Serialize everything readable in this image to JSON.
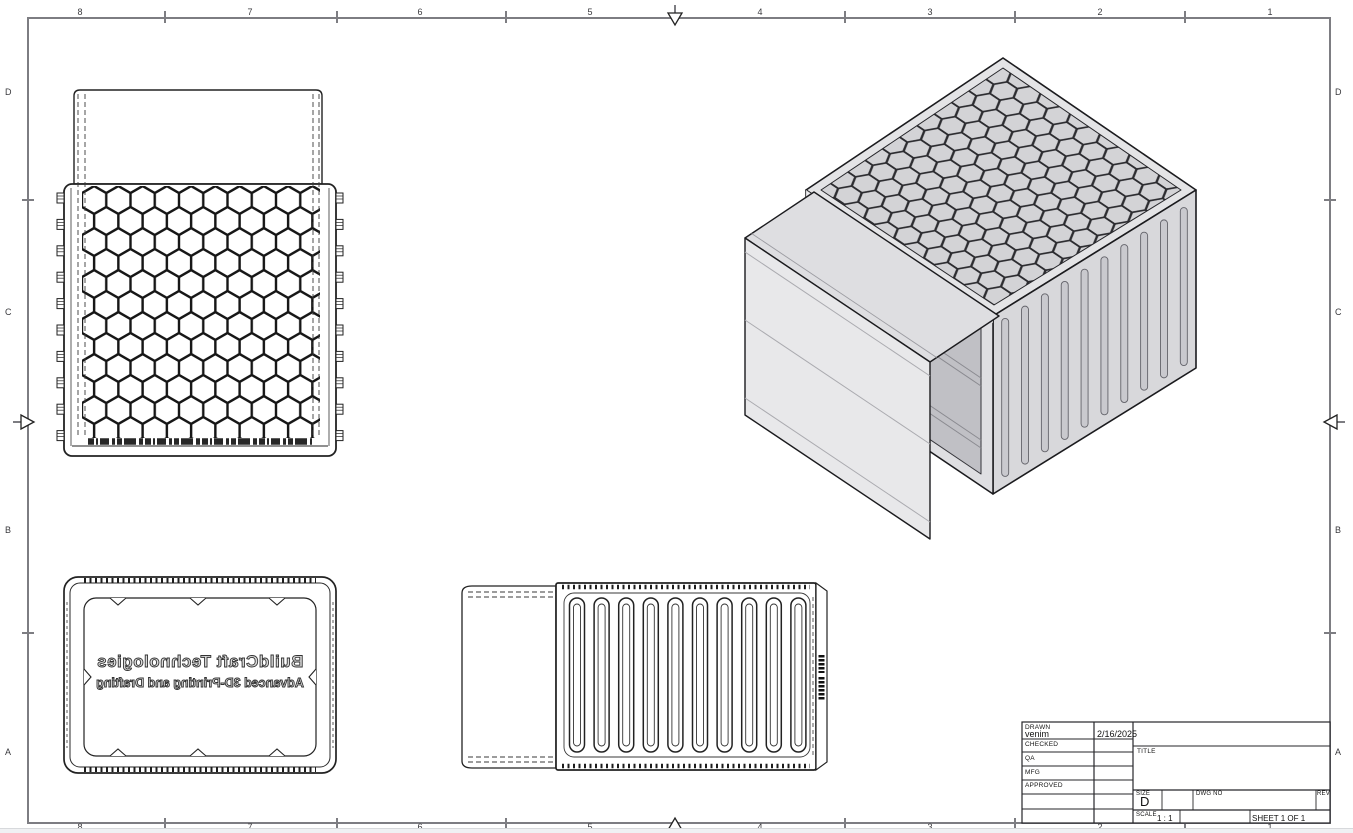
{
  "sheet": {
    "zones_top": [
      "8",
      "7",
      "6",
      "5",
      "4",
      "3",
      "2",
      "1"
    ],
    "zones_bottom": [
      "8",
      "7",
      "6",
      "5",
      "4",
      "3",
      "2",
      "1"
    ],
    "zones_left": [
      "D",
      "C",
      "B",
      "A"
    ],
    "zones_right": [
      "D",
      "C",
      "B",
      "A"
    ]
  },
  "title_block": {
    "drawn_label": "DRAWN",
    "drawn_by": "venim",
    "drawn_date": "2/16/2025",
    "checked_label": "CHECKED",
    "qa_label": "QA",
    "mfg_label": "MFG",
    "approved_label": "APPROVED",
    "title_label": "TITLE",
    "size_label": "SIZE",
    "size_value": "D",
    "dwg_no_label": "DWG NO",
    "rev_label": "REV",
    "scale_label": "SCALE",
    "scale_value": "1 : 1",
    "sheet_value": "SHEET 1  OF 1"
  },
  "part_marking": {
    "line1": "BuildCraft Technologies",
    "line2": "Advanced 3D-Printing and Drafting"
  },
  "geometry": {
    "front_rib_tabs_per_side": 10,
    "side_view_slots": 10,
    "isometric_ribs": 10
  },
  "colors": {
    "border_gray": "#7d7d82",
    "line_dark": "#222222",
    "iso_face_light": "#e4e4e6",
    "iso_face_mid": "#d8d8db",
    "iso_interior": "#c0c0c5"
  }
}
